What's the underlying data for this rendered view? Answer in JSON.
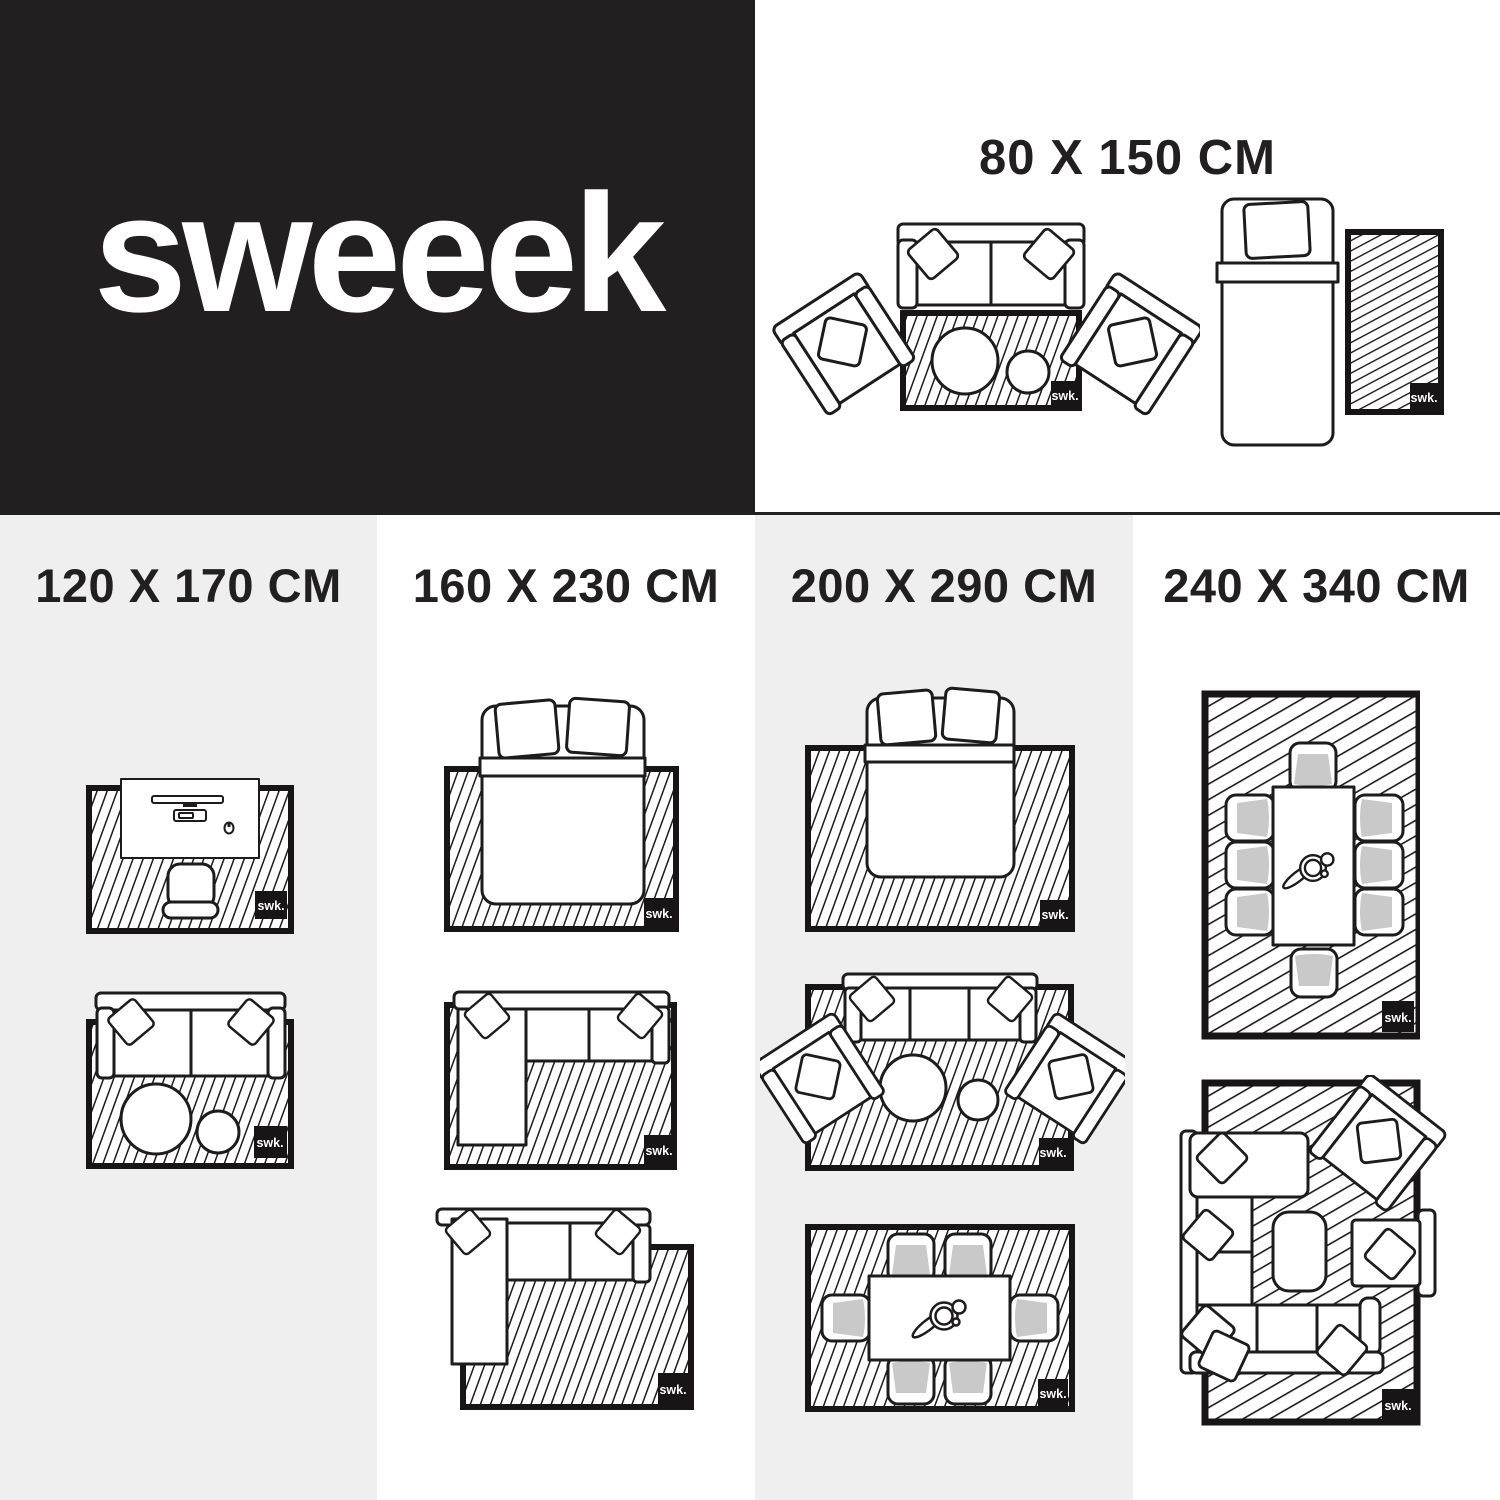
{
  "brand": {
    "logo_text": "sweeek",
    "badge_label": "swk."
  },
  "hero": {
    "size_label": "80 X 150 CM",
    "diagrams": [
      "sofa-with-two-armchairs-and-coffee-tables",
      "single-bed-with-bedside-runner-rug"
    ]
  },
  "size_columns": [
    {
      "size_label": "120 X 170 CM",
      "diagrams": [
        "desk-with-office-chair",
        "two-seater-sofa-with-coffee-tables"
      ]
    },
    {
      "size_label": "160 X 230 CM",
      "diagrams": [
        "double-bed",
        "corner-sofa-on-rug",
        "corner-sofa-overhanging-rug"
      ]
    },
    {
      "size_label": "200 X 290 CM",
      "diagrams": [
        "double-bed-wide-rug",
        "three-seater-sofa-with-armchairs",
        "dining-table-six-chairs"
      ]
    },
    {
      "size_label": "240 X 340 CM",
      "diagrams": [
        "dining-table-eight-chairs",
        "large-corner-sofa-with-armchairs"
      ]
    }
  ],
  "colors": {
    "black_panel": "#211f20",
    "light_gray": "#efefef",
    "white": "#ffffff",
    "line": "#1d1b1c",
    "cushion_gray": "#c9c9c9",
    "badge_black": "#171515"
  }
}
